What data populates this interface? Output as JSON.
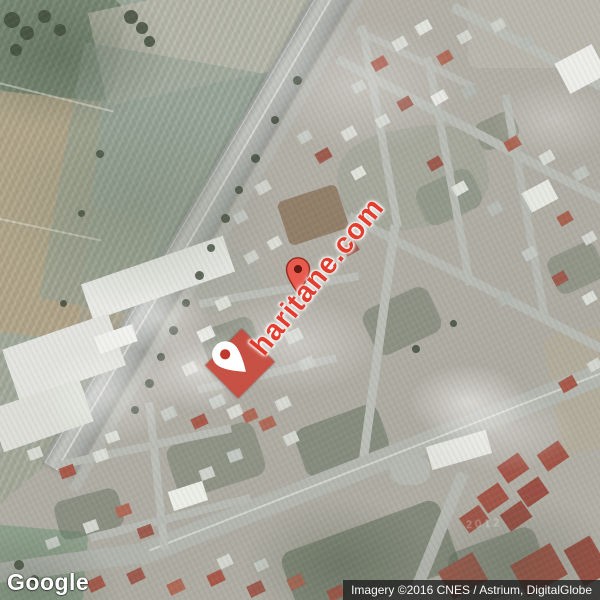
{
  "map": {
    "watermark": "haritane.com",
    "faint_year_label": "2012"
  },
  "markers": {
    "parcel_highlight": {
      "shape": "red-diamond",
      "icon": "white-map-pin-icon",
      "color": "#c8493c",
      "pin_color": "#ffffff"
    },
    "place_pin": {
      "icon": "red-map-pin-icon",
      "color": "#e85a4e"
    }
  },
  "branding": {
    "logo_text": "Google"
  },
  "attribution": {
    "text": "Imagery ©2016 CNES / Astrium, DigitalGlobe"
  },
  "colors": {
    "watermark_red": "#e5392b",
    "parcel_marker_red": "#c8493c",
    "pin_red": "#e85a4e",
    "attribution_background": "#1e1e1e",
    "attribution_text": "#fafafa",
    "google_logo_text": "#ffffff"
  }
}
